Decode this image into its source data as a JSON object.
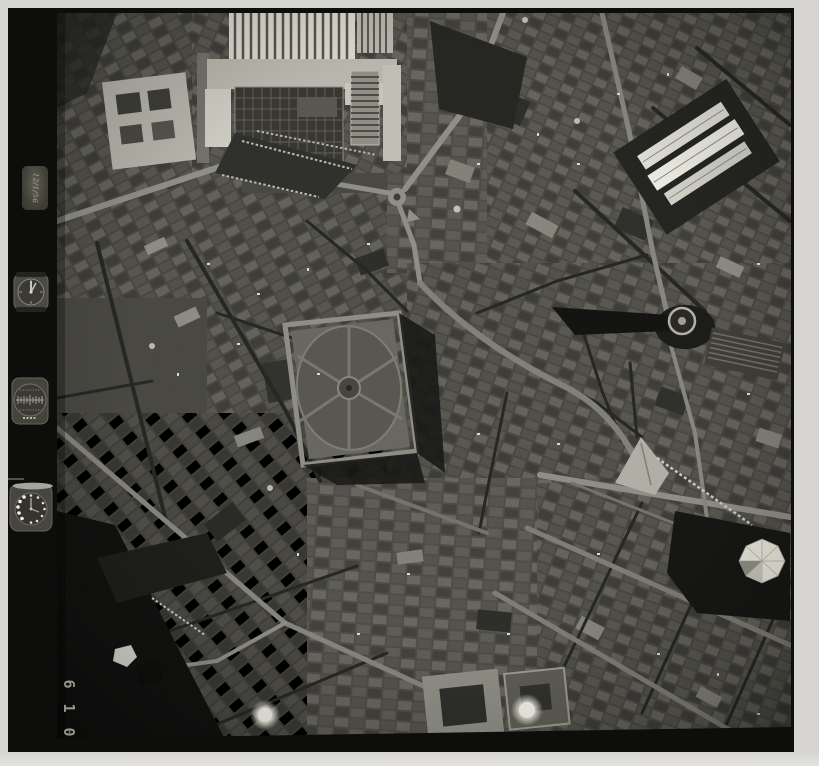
{
  "document": {
    "type_label": "Black-and-white vertical aerial photograph film frame of a dense European city centre",
    "scene": "old-town street mesh with piazzas, a formal parterre garden, factory halls, market halls and radiating avenues"
  },
  "film_frame": {
    "frame_number": "610",
    "frame_number_digits": [
      "6",
      "1",
      "0"
    ],
    "data_plate_text": "12/1/56",
    "instruments": [
      {
        "name": "clock-dial"
      },
      {
        "name": "altimeter-dial"
      },
      {
        "name": "watch-dial"
      }
    ]
  },
  "palette": {
    "paper_margin": "#d6d5d2",
    "film_black": "#0d0d0c",
    "photo_base": "#45443f",
    "street_light": "#8c8b83",
    "street_dark": "#232320",
    "roof_light": "#c9c8bd",
    "highlight_white": "#efeee4"
  },
  "features": [
    "sawtooth-factory-roofs",
    "tree-lined-triangular-plaza",
    "roundabout-junction",
    "formal-garden-parterre",
    "three-white-market-halls",
    "round-tower-with-long-shadow",
    "faceted-white-dome",
    "glowing-dome-highlights",
    "courtyard-palazzo-blocks",
    "old-town-street-mesh"
  ]
}
